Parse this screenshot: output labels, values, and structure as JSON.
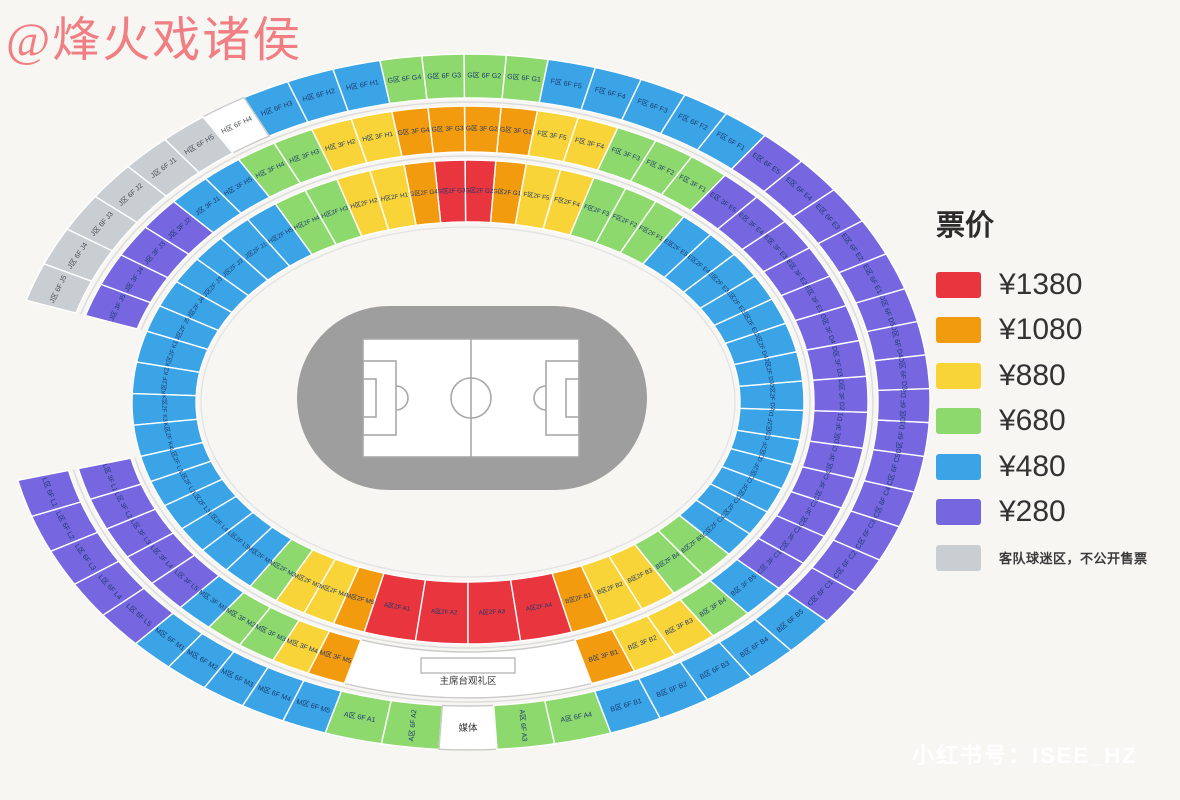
{
  "watermarks": {
    "author": "@烽火戏诸侯",
    "xiaohongshu": "小红书号：ISEE_HZ"
  },
  "legend": {
    "title": "票价",
    "items": [
      {
        "color": "red",
        "label": "¥1380"
      },
      {
        "color": "orange",
        "label": "¥1080"
      },
      {
        "color": "yellow",
        "label": "¥880"
      },
      {
        "color": "green",
        "label": "¥680"
      },
      {
        "color": "blue",
        "label": "¥480"
      },
      {
        "color": "purple",
        "label": "¥280"
      },
      {
        "color": "gray",
        "label": "客队球迷区，不公开售票",
        "small": true
      }
    ]
  },
  "palette": {
    "red": "#e8353e",
    "orange": "#f39b0e",
    "yellow": "#f8d438",
    "green": "#8ed96e",
    "blue": "#3ba4e6",
    "purple": "#7666e0",
    "gray": "#c9ced3",
    "white": "#ffffff"
  },
  "label_color": "#1c3a6e",
  "stadium": {
    "cx": 468,
    "cy": 402,
    "rings": [
      {
        "id": "6F",
        "r_in": [
          410,
          304
        ],
        "r_out": [
          462,
          348
        ],
        "sections": [
          {
            "name": "A",
            "start": 108,
            "end": 72,
            "segs": [
              [
                "A区 6F A1",
                "green"
              ],
              [
                "A区 6F A2",
                "green",
                "radial"
              ],
              [
                "媒体",
                "white",
                "media"
              ],
              [
                "A区 6F A3",
                "green",
                "radial"
              ],
              [
                "A区 6F A4",
                "green"
              ]
            ]
          },
          {
            "name": "B",
            "start": 72,
            "end": 39,
            "segs": [
              [
                "B区 6F B1",
                "blue"
              ],
              [
                "B区 6F B2",
                "blue"
              ],
              [
                "B区 6F B3",
                "blue"
              ],
              [
                "B区 6F B4",
                "blue"
              ],
              [
                "B区 6F B5",
                "blue"
              ]
            ]
          },
          {
            "name": "C",
            "start": 39,
            "end": 9,
            "segs": [
              [
                "C区 6F C1",
                "purple"
              ],
              [
                "C区 6F C2",
                "purple"
              ],
              [
                "C区 6F C3",
                "purple"
              ],
              [
                "C区 6F C4",
                "purple"
              ],
              [
                "C区 6F C5",
                "purple"
              ]
            ]
          },
          {
            "name": "D",
            "start": 9,
            "end": -19,
            "segs": [
              [
                "D区 6F D1",
                "purple"
              ],
              [
                "D区 6F D2",
                "purple"
              ],
              [
                "D区 6F D3",
                "purple"
              ],
              [
                "D区 6F D4",
                "purple"
              ],
              [
                "D区 6F D5",
                "purple"
              ]
            ]
          },
          {
            "name": "E",
            "start": -19,
            "end": -50,
            "segs": [
              [
                "E区 6F E1",
                "purple"
              ],
              [
                "E区 6F E2",
                "purple"
              ],
              [
                "E区 6F E3",
                "purple"
              ],
              [
                "E区 6F E4",
                "purple"
              ],
              [
                "E区 6F E5",
                "purple"
              ]
            ]
          },
          {
            "name": "F",
            "start": -50,
            "end": -80,
            "segs": [
              [
                "F区 6F F1",
                "blue"
              ],
              [
                "F区 6F F2",
                "blue"
              ],
              [
                "F区 6F F3",
                "blue"
              ],
              [
                "F区 6F F4",
                "blue"
              ],
              [
                "F区 6F F5",
                "blue"
              ]
            ]
          },
          {
            "name": "G",
            "start": -80,
            "end": -101,
            "segs": [
              [
                "G区 6F G1",
                "green"
              ],
              [
                "G区 6F G2",
                "green"
              ],
              [
                "G区 6F G3",
                "green"
              ],
              [
                "G区 6F G4",
                "green"
              ]
            ]
          },
          {
            "name": "H",
            "start": -101,
            "end": -131,
            "segs": [
              [
                "H区 6F H1",
                "blue"
              ],
              [
                "H区 6F H2",
                "blue"
              ],
              [
                "H区 6F H3",
                "blue"
              ],
              [
                "H区 6F H4",
                "white"
              ],
              [
                "H区 6F H5",
                "gray"
              ]
            ]
          },
          {
            "name": "J",
            "start": -131,
            "end": -163,
            "segs": [
              [
                "J区 6F J1",
                "gray"
              ],
              [
                "J区 6F J2",
                "gray"
              ],
              [
                "J区 6F J3",
                "gray"
              ],
              [
                "J区 6F J4",
                "gray"
              ],
              [
                "J区 6F J5",
                "gray"
              ]
            ]
          },
          {
            "name": "L",
            "start": -193,
            "end": -224,
            "segs": [
              [
                "L区 6F L1",
                "purple"
              ],
              [
                "L区 6F L2",
                "purple"
              ],
              [
                "L区 6F L3",
                "purple"
              ],
              [
                "L区 6F L4",
                "purple"
              ],
              [
                "L区 6F L5",
                "purple"
              ]
            ]
          },
          {
            "name": "M",
            "start": -224,
            "end": -252,
            "segs": [
              [
                "M区 6F M1",
                "blue"
              ],
              [
                "M区 6F M2",
                "blue"
              ],
              [
                "M区 6F M3",
                "blue"
              ],
              [
                "M区 6F M4",
                "blue"
              ],
              [
                "M区 6F M5",
                "blue"
              ]
            ]
          }
        ]
      },
      {
        "id": "3F",
        "r_in": [
          346,
          250
        ],
        "r_out": [
          400,
          296
        ],
        "sections": [
          {
            "name": "A",
            "start": 108,
            "end": 72,
            "segs": [
              [
                "主席台观礼区",
                "white",
                "rostrum"
              ]
            ]
          },
          {
            "name": "B",
            "start": 72,
            "end": 39,
            "segs": [
              [
                "B区 3F B1",
                "orange"
              ],
              [
                "B区 3F B2",
                "yellow"
              ],
              [
                "B区 3F B3",
                "yellow"
              ],
              [
                "B区 3F B4",
                "green"
              ],
              [
                "B区 3F B5",
                "blue"
              ]
            ]
          },
          {
            "name": "C",
            "start": 39,
            "end": 9,
            "segs": [
              [
                "C区 3F C1",
                "purple"
              ],
              [
                "C区 3F C2",
                "purple"
              ],
              [
                "C区 3F C3",
                "purple"
              ],
              [
                "C区 3F C4",
                "purple"
              ],
              [
                "C区 3F C5",
                "purple"
              ]
            ]
          },
          {
            "name": "D",
            "start": 9,
            "end": -19,
            "segs": [
              [
                "D区 3F D1",
                "purple"
              ],
              [
                "D区 3F D2",
                "purple"
              ],
              [
                "D区 3F D3",
                "purple"
              ],
              [
                "D区 3F D4",
                "purple"
              ]
            ]
          },
          {
            "name": "E",
            "start": -19,
            "end": -50,
            "segs": [
              [
                "E区 3F E1",
                "purple"
              ],
              [
                "E区 3F E2",
                "purple"
              ],
              [
                "E区 3F E3",
                "purple"
              ],
              [
                "E区 3F E4",
                "purple"
              ],
              [
                "E区 3F E5",
                "purple"
              ]
            ]
          },
          {
            "name": "F",
            "start": -50,
            "end": -80,
            "segs": [
              [
                "F区 3F F1",
                "green"
              ],
              [
                "F区 3F F2",
                "green"
              ],
              [
                "F区 3F F3",
                "green"
              ],
              [
                "F区 3F F4",
                "yellow"
              ],
              [
                "F区 3F F5",
                "yellow"
              ]
            ]
          },
          {
            "name": "G",
            "start": -80,
            "end": -101,
            "segs": [
              [
                "G区 3F G1",
                "orange"
              ],
              [
                "G区 3F G2",
                "orange"
              ],
              [
                "G区 3F G3",
                "orange"
              ],
              [
                "G区 3F G4",
                "orange"
              ]
            ]
          },
          {
            "name": "H",
            "start": -101,
            "end": -131,
            "segs": [
              [
                "H区 3F H1",
                "yellow"
              ],
              [
                "H区 3F H2",
                "yellow"
              ],
              [
                "H区 3F H3",
                "green"
              ],
              [
                "H区 3F H4",
                "green"
              ],
              [
                "H区 3F H5",
                "blue"
              ]
            ]
          },
          {
            "name": "J",
            "start": -131,
            "end": -163,
            "segs": [
              [
                "J区 3F J1",
                "blue"
              ],
              [
                "J区 3F J2",
                "purple"
              ],
              [
                "J区 3F J3",
                "purple"
              ],
              [
                "J区 3F J4",
                "purple"
              ],
              [
                "J区 3F J5",
                "purple"
              ]
            ]
          },
          {
            "name": "L",
            "start": -193,
            "end": -224,
            "segs": [
              [
                "L区 3F L1",
                "purple"
              ],
              [
                "L区 3F L2",
                "purple"
              ],
              [
                "L区 3F L3",
                "purple"
              ],
              [
                "L区 3F L4",
                "purple"
              ],
              [
                "L区 3F L5",
                "purple"
              ]
            ]
          },
          {
            "name": "M",
            "start": -224,
            "end": -252,
            "segs": [
              [
                "M区 3F M1",
                "blue"
              ],
              [
                "M区 3F M2",
                "green"
              ],
              [
                "M区 3F M3",
                "green"
              ],
              [
                "M区 3F M4",
                "yellow"
              ],
              [
                "M区 3F M5",
                "orange"
              ]
            ]
          }
        ]
      },
      {
        "id": "2F",
        "r_in": [
          272,
          180
        ],
        "r_out": [
          336,
          242
        ],
        "sections": [
          {
            "name": "A",
            "start": 108,
            "end": 72,
            "segs": [
              [
                "A区2F A1",
                "red"
              ],
              [
                "A区2F A2",
                "red"
              ],
              [
                "A区2F A3",
                "red"
              ],
              [
                "A区2F A4",
                "red"
              ]
            ]
          },
          {
            "name": "B",
            "start": 72,
            "end": 39,
            "segs": [
              [
                "B区2F B1",
                "orange"
              ],
              [
                "B区2F B2",
                "yellow"
              ],
              [
                "B区2F B3",
                "yellow"
              ],
              [
                "B区2F B4",
                "green"
              ],
              [
                "B区2F B5",
                "green"
              ]
            ]
          },
          {
            "name": "C",
            "start": 39,
            "end": 9,
            "segs": [
              [
                "C区2F C1",
                "blue"
              ],
              [
                "C区2F C2",
                "blue"
              ],
              [
                "C区2F C3",
                "blue"
              ],
              [
                "C区2F C4",
                "blue"
              ],
              [
                "C区2F C5",
                "blue"
              ]
            ]
          },
          {
            "name": "D",
            "start": 9,
            "end": -19,
            "segs": [
              [
                "D区2F D1",
                "blue"
              ],
              [
                "D区2F D2",
                "blue"
              ],
              [
                "D区2F D3",
                "blue"
              ],
              [
                "D区2F D4",
                "blue"
              ]
            ]
          },
          {
            "name": "E",
            "start": -19,
            "end": -50,
            "segs": [
              [
                "E区2F E1",
                "blue"
              ],
              [
                "E区2F E2",
                "blue"
              ],
              [
                "E区2F E3",
                "blue"
              ],
              [
                "E区2F E4",
                "blue"
              ],
              [
                "E区2F E5",
                "blue"
              ]
            ]
          },
          {
            "name": "F",
            "start": -50,
            "end": -80,
            "segs": [
              [
                "F区2F F1",
                "green"
              ],
              [
                "F区2F F2",
                "green"
              ],
              [
                "F区2F F3",
                "green"
              ],
              [
                "F区2F F4",
                "yellow"
              ],
              [
                "F区2F F5",
                "yellow"
              ]
            ]
          },
          {
            "name": "G",
            "start": -80,
            "end": -101,
            "segs": [
              [
                "G区2F G1",
                "orange"
              ],
              [
                "G区2F G2",
                "red"
              ],
              [
                "G区2F G3",
                "red"
              ],
              [
                "G区2F G4",
                "orange"
              ]
            ]
          },
          {
            "name": "H",
            "start": -101,
            "end": -131,
            "segs": [
              [
                "H区2F H1",
                "yellow"
              ],
              [
                "H区2F H2",
                "yellow"
              ],
              [
                "H区2F H3",
                "green"
              ],
              [
                "H区2F H4",
                "green"
              ],
              [
                "H区2F H5",
                "blue"
              ]
            ]
          },
          {
            "name": "J",
            "start": -131,
            "end": -163,
            "segs": [
              [
                "J区2F J1",
                "blue"
              ],
              [
                "J区2F J2",
                "blue"
              ],
              [
                "J区2F J3",
                "blue"
              ],
              [
                "J区2F J4",
                "blue"
              ],
              [
                "J区2F J5",
                "blue"
              ]
            ]
          },
          {
            "name": "K",
            "start": -163,
            "end": -193,
            "segs": [
              [
                "K区2F K1",
                "blue"
              ],
              [
                "K区2F K2",
                "blue"
              ],
              [
                "K区2F K3",
                "blue"
              ],
              [
                "K区2F K4",
                "blue"
              ]
            ]
          },
          {
            "name": "L",
            "start": -193,
            "end": -224,
            "segs": [
              [
                "L区2F L1",
                "blue"
              ],
              [
                "L区2F L2",
                "blue"
              ],
              [
                "L区2F L3",
                "blue"
              ],
              [
                "L区2F L4",
                "blue"
              ],
              [
                "L区2F L5",
                "blue"
              ]
            ]
          },
          {
            "name": "M",
            "start": -224,
            "end": -252,
            "segs": [
              [
                "M区2F M1",
                "blue"
              ],
              [
                "M区2F M2",
                "green"
              ],
              [
                "M区2F M3",
                "yellow"
              ],
              [
                "M区2F M4",
                "yellow"
              ],
              [
                "M区2F M5",
                "orange"
              ]
            ]
          }
        ]
      }
    ]
  },
  "pitch": {
    "track": {
      "x": 297,
      "y": 306,
      "w": 350,
      "h": 184,
      "r": 92,
      "color": "#9e9e9e"
    },
    "field": {
      "x": 363,
      "y": 339,
      "w": 216,
      "h": 118,
      "line": "#a8a8a8"
    }
  }
}
